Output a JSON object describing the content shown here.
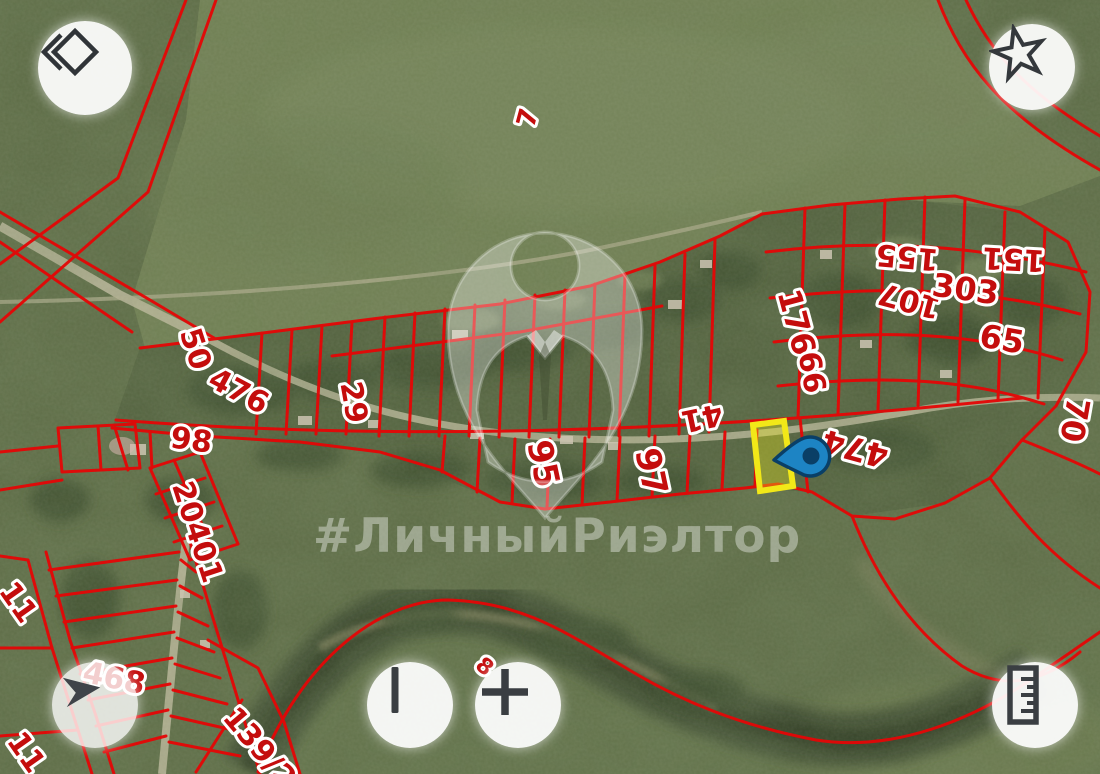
{
  "app": {
    "type": "cadastral-satellite-map-viewer"
  },
  "watermark": {
    "text": "#ЛичныйРиэлтор",
    "icon": "realtor-person-pin-icon"
  },
  "map": {
    "imagery": "satellite",
    "parcel_line_color": "#e50606",
    "label_color": "#c40d0d",
    "label_halo_color": "#ffffff",
    "parcel_labels": [
      {
        "text": "7",
        "x": 536,
        "y": 120,
        "rotation": -75,
        "size": 26
      },
      {
        "text": "50",
        "x": 186,
        "y": 352,
        "rotation": 72,
        "size": 30
      },
      {
        "text": "476",
        "x": 234,
        "y": 400,
        "rotation": 28,
        "size": 30
      },
      {
        "text": "29",
        "x": 344,
        "y": 404,
        "rotation": 80,
        "size": 30
      },
      {
        "text": "98",
        "x": 190,
        "y": 450,
        "rotation": 8,
        "size": 30
      },
      {
        "text": "20401",
        "x": 188,
        "y": 535,
        "rotation": 72,
        "size": 30
      },
      {
        "text": "95",
        "x": 532,
        "y": 466,
        "rotation": 78,
        "size": 34
      },
      {
        "text": "97",
        "x": 640,
        "y": 474,
        "rotation": 78,
        "size": 34
      },
      {
        "text": "41",
        "x": 700,
        "y": 408,
        "rotation": 168,
        "size": 30
      },
      {
        "text": "176",
        "x": 786,
        "y": 325,
        "rotation": 75,
        "size": 32
      },
      {
        "text": "66",
        "x": 802,
        "y": 374,
        "rotation": 80,
        "size": 30
      },
      {
        "text": "474",
        "x": 858,
        "y": 438,
        "rotation": 195,
        "size": 32
      },
      {
        "text": "155",
        "x": 908,
        "y": 247,
        "rotation": 185,
        "size": 30
      },
      {
        "text": "107",
        "x": 912,
        "y": 291,
        "rotation": 195,
        "size": 30
      },
      {
        "text": "151",
        "x": 1014,
        "y": 249,
        "rotation": 183,
        "size": 30
      },
      {
        "text": "303",
        "x": 964,
        "y": 300,
        "rotation": 8,
        "size": 32
      },
      {
        "text": "65",
        "x": 1000,
        "y": 350,
        "rotation": 10,
        "size": 32
      },
      {
        "text": "70",
        "x": 1064,
        "y": 418,
        "rotation": 100,
        "size": 32
      },
      {
        "text": "468",
        "x": 112,
        "y": 688,
        "rotation": 12,
        "size": 30
      },
      {
        "text": "11",
        "x": 10,
        "y": 608,
        "rotation": 55,
        "size": 30
      },
      {
        "text": "11",
        "x": 18,
        "y": 758,
        "rotation": 55,
        "size": 30
      },
      {
        "text": "8",
        "x": 480,
        "y": 672,
        "rotation": 40,
        "size": 22
      },
      {
        "text": "139/2",
        "x": 252,
        "y": 754,
        "rotation": 50,
        "size": 30
      }
    ]
  },
  "highlight": {
    "name": "selected-parcel",
    "parcel_fill": "rgba(235,232,25,0.35)",
    "parcel_stroke": "#f2e818",
    "pin_fill": "#1d84c4",
    "pin_stroke": "#0a3f66"
  },
  "controls": {
    "back": {
      "icon": "back-diamond-icon"
    },
    "favorite": {
      "icon": "star-icon"
    },
    "compass": {
      "icon": "navigation-arrow-icon"
    },
    "zoom_out": {
      "icon": "zoom-out-bar-icon"
    },
    "zoom_in": {
      "icon": "plus-icon"
    },
    "measure": {
      "icon": "ruler-icon"
    }
  }
}
